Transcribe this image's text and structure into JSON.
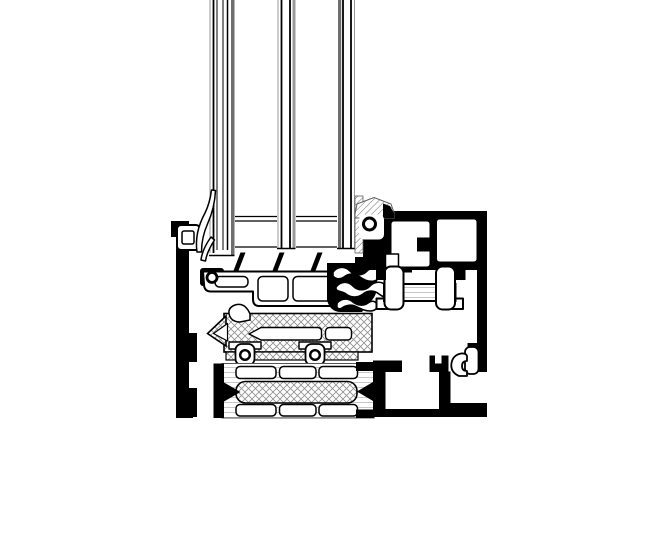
{
  "canvas": {
    "width": 648,
    "height": 540,
    "background": "#ffffff"
  },
  "palette": {
    "ink": "#000000",
    "paper": "#ffffff",
    "hatch": "#8f8f8f",
    "hatch_dark": "#5f5f5f",
    "hatch_light": "#b9b9b9",
    "glass_gray": "#9a9a9a",
    "glass_dark": "#6e6e6e",
    "edge_gray": "#555555"
  },
  "drawing": {
    "kind": "technical-cross-section",
    "subject": "aluminium-window-frame-sill-profile",
    "parts": [
      "triple-insulated-glazing",
      "glazing-spacer-bars",
      "outer-glazing-bead-strip",
      "bead-clip",
      "outer-glazing-gasket",
      "sash-glazing-support-profile",
      "drainage-fins",
      "corner-gasket-roller",
      "center-seal-gaskets",
      "inner-glazing-gasket-wedge",
      "main-frame-profile",
      "frame-hollow-chambers",
      "screw-boss",
      "screw-channel",
      "thermal-break-hat-profile",
      "frame-outer-wall",
      "outer-clip-gasket",
      "sash-bottom-insert",
      "omega-retainer-clips",
      "insulating-bar",
      "foam-core",
      "sill-base-profile"
    ]
  }
}
